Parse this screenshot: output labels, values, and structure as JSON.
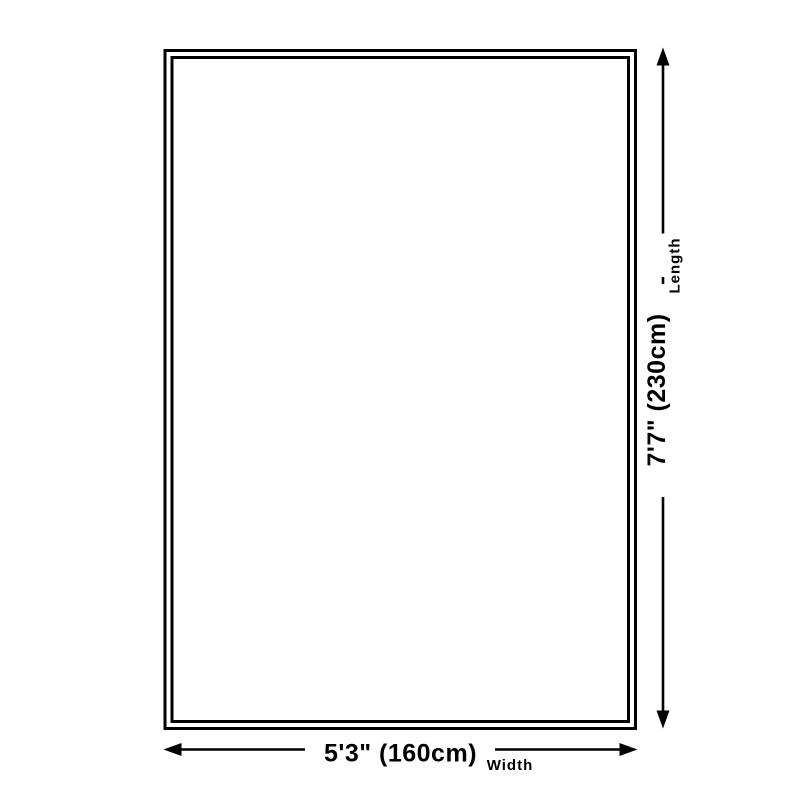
{
  "colors": {
    "ink": "#000000",
    "background": "#ffffff"
  },
  "diagram": {
    "length_dimension": {
      "value_label": "7'7\" (230cm)",
      "axis_label": "Length"
    },
    "width_dimension": {
      "value_label": "5'3\" (160cm)",
      "axis_label": "Width"
    }
  }
}
